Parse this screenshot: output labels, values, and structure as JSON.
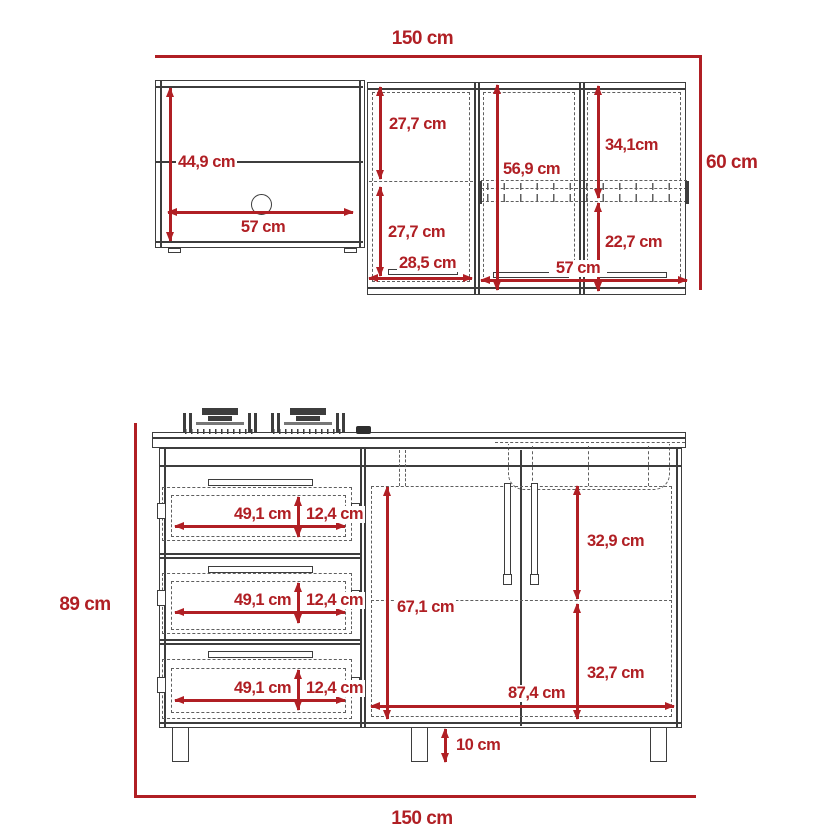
{
  "colors": {
    "dimension_red": "#B01F24",
    "drawing_line": "#3D3D3D"
  },
  "upper_section": {
    "overall_width": "150 cm",
    "overall_height": "60 cm",
    "open_cabinet": {
      "inner_height": "44,9 cm",
      "inner_width": "57 cm"
    },
    "single_door": {
      "upper_half_height": "27,7 cm",
      "lower_half_height": "27,7 cm",
      "door_width": "28,5 cm"
    },
    "double_door": {
      "door_height": "56,9 cm",
      "upper_right_height": "34,1cm",
      "lower_right_height": "22,7 cm",
      "doors_width": "57 cm"
    }
  },
  "lower_section": {
    "overall_height": "89 cm",
    "overall_width": "150 cm",
    "drawers": [
      {
        "width": "49,1 cm",
        "height": "12,4 cm"
      },
      {
        "width": "49,1 cm",
        "height": "12,4 cm"
      },
      {
        "width": "49,1 cm",
        "height": "12,4 cm"
      }
    ],
    "double_door": {
      "door_height": "67,1 cm",
      "upper_right_height": "32,9 cm",
      "lower_right_height": "32,7 cm",
      "doors_width": "87,4 cm"
    },
    "leg_height": "10 cm"
  }
}
